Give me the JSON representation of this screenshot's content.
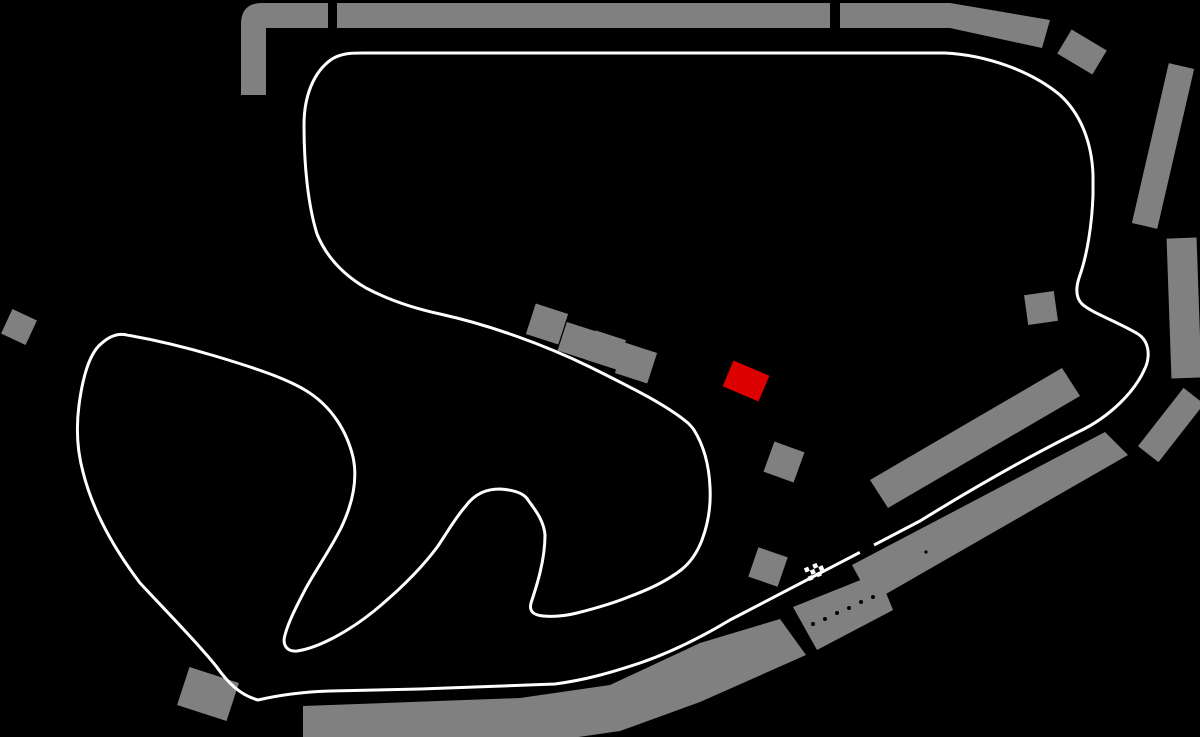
{
  "canvas": {
    "width": 1200,
    "height": 737,
    "background": "#000000"
  },
  "colors": {
    "track": "#ffffff",
    "grandstand": "#808080",
    "pit_building": "#dc0000",
    "background": "#000000"
  },
  "track": {
    "stroke_width": 3,
    "path": "M363 53 L945 53 C985 55 1030 70 1060 95 C1082 115 1092 145 1093 175 L1093 195 C1092 225 1087 255 1080 275 C1076 286 1075 297 1082 304 C1092 313 1118 322 1138 334 C1149 341 1150 355 1146 366 C1136 391 1110 417 1078 432 C1030 456 975 487 920 521 L730 620 C700 638 672 652 640 663 C610 673 585 680 555 684 L420 689 L330 691 C300 692 275 696 258 700 C240 695 228 683 216 666 C195 640 165 610 140 583 C115 550 93 512 83 472 C77 450 76 428 79 405 C83 375 90 352 102 343 C110 336 118 333 127 335 C155 340 185 347 215 356 C255 368 285 378 305 390 C332 406 347 432 353 457 C358 480 352 505 341 528 C330 550 317 568 306 588 C296 607 288 623 285 635 C282 645 287 652 297 651 C318 648 348 632 374 611 C402 588 424 565 438 546 C450 528 456 517 465 507 C475 493 487 489 500 489 C514 490 524 493 528 500 C537 512 544 522 545 535 C545 560 537 585 531 603 C529 611 533 615 543 616 C555 617 565 616 577 613 C597 608 614 603 631 596 C650 589 668 580 681 570 C690 563 697 553 702 540 C708 524 711 505 710 487 C709 465 704 446 694 430 C692 427 690 425 688 423 C665 404 630 387 590 367 C545 345 490 325 440 314 C408 307 385 298 366 288 C342 274 326 256 317 234 C308 205 304 165 304 125 C304 97 313 72 332 59 C342 53 352 53 363 53 Z",
    "start_finish_gap": {
      "cx": 866,
      "cy": 547,
      "w": 16,
      "h": 9,
      "angle": -28
    }
  },
  "start_finish_flag": {
    "cx": 815,
    "cy": 571,
    "angle": -24,
    "rows": 3,
    "cols": 4,
    "cell": 4.6
  },
  "pit_building": {
    "cx": 746,
    "cy": 381,
    "w": 39,
    "h": 28,
    "angle": 23
  },
  "grandstands": {
    "paths": [
      "M241 95 L241 24 Q241 3 262 3 L328 3 L328 28 L266 28 L266 95 Z"
    ],
    "polygons": [
      [
        [
          337,
          3
        ],
        [
          830,
          3
        ],
        [
          830,
          28
        ],
        [
          337,
          28
        ]
      ],
      [
        [
          840,
          3
        ],
        [
          950,
          3
        ],
        [
          1050,
          20
        ],
        [
          1042,
          48
        ],
        [
          950,
          28
        ],
        [
          840,
          28
        ]
      ],
      [
        [
          870,
          480
        ],
        [
          1062,
          368
        ],
        [
          1080,
          396
        ],
        [
          888,
          508
        ]
      ],
      [
        [
          852,
          565
        ],
        [
          1105,
          432
        ],
        [
          1128,
          455
        ],
        [
          872,
          602
        ]
      ],
      [
        [
          793,
          607
        ],
        [
          878,
          573
        ],
        [
          893,
          610
        ],
        [
          817,
          650
        ]
      ],
      [
        [
          303,
          706
        ],
        [
          520,
          698
        ],
        [
          610,
          685
        ],
        [
          700,
          643
        ],
        [
          780,
          619
        ],
        [
          806,
          655
        ],
        [
          700,
          702
        ],
        [
          620,
          731
        ],
        [
          530,
          744
        ],
        [
          303,
          748
        ]
      ]
    ],
    "rects": [
      {
        "cx": 1082,
        "cy": 52,
        "w": 41,
        "h": 28,
        "angle": 31
      },
      {
        "cx": 1163,
        "cy": 146,
        "w": 26,
        "h": 164,
        "angle": 13
      },
      {
        "cx": 1184,
        "cy": 308,
        "w": 30,
        "h": 140,
        "angle": -2
      },
      {
        "cx": 1171,
        "cy": 425,
        "w": 26,
        "h": 74,
        "angle": 38
      },
      {
        "cx": 1041,
        "cy": 308,
        "w": 30,
        "h": 30,
        "angle": -8
      },
      {
        "cx": 208,
        "cy": 694,
        "w": 52,
        "h": 40,
        "angle": 18
      },
      {
        "cx": 768,
        "cy": 567,
        "w": 31,
        "h": 31,
        "angle": 19
      },
      {
        "cx": 784,
        "cy": 462,
        "w": 32,
        "h": 32,
        "angle": 20
      },
      {
        "cx": 547,
        "cy": 324,
        "w": 34,
        "h": 32,
        "angle": 18
      },
      {
        "cx": 577,
        "cy": 341,
        "w": 31,
        "h": 30,
        "angle": 18
      },
      {
        "cx": 606,
        "cy": 350,
        "w": 32,
        "h": 31,
        "angle": 18
      },
      {
        "cx": 636,
        "cy": 363,
        "w": 34,
        "h": 32,
        "angle": 18
      },
      {
        "cx": 19,
        "cy": 327,
        "w": 27,
        "h": 27,
        "angle": 25
      }
    ]
  },
  "pit_garage_dots": {
    "radius": 2,
    "points": [
      [
        813,
        624
      ],
      [
        825,
        619
      ],
      [
        837,
        613
      ],
      [
        849,
        608
      ],
      [
        861,
        602
      ],
      [
        873,
        597
      ]
    ]
  },
  "grandstand_marks": {
    "radius": 1.6,
    "points": [
      [
        926,
        552
      ]
    ]
  }
}
